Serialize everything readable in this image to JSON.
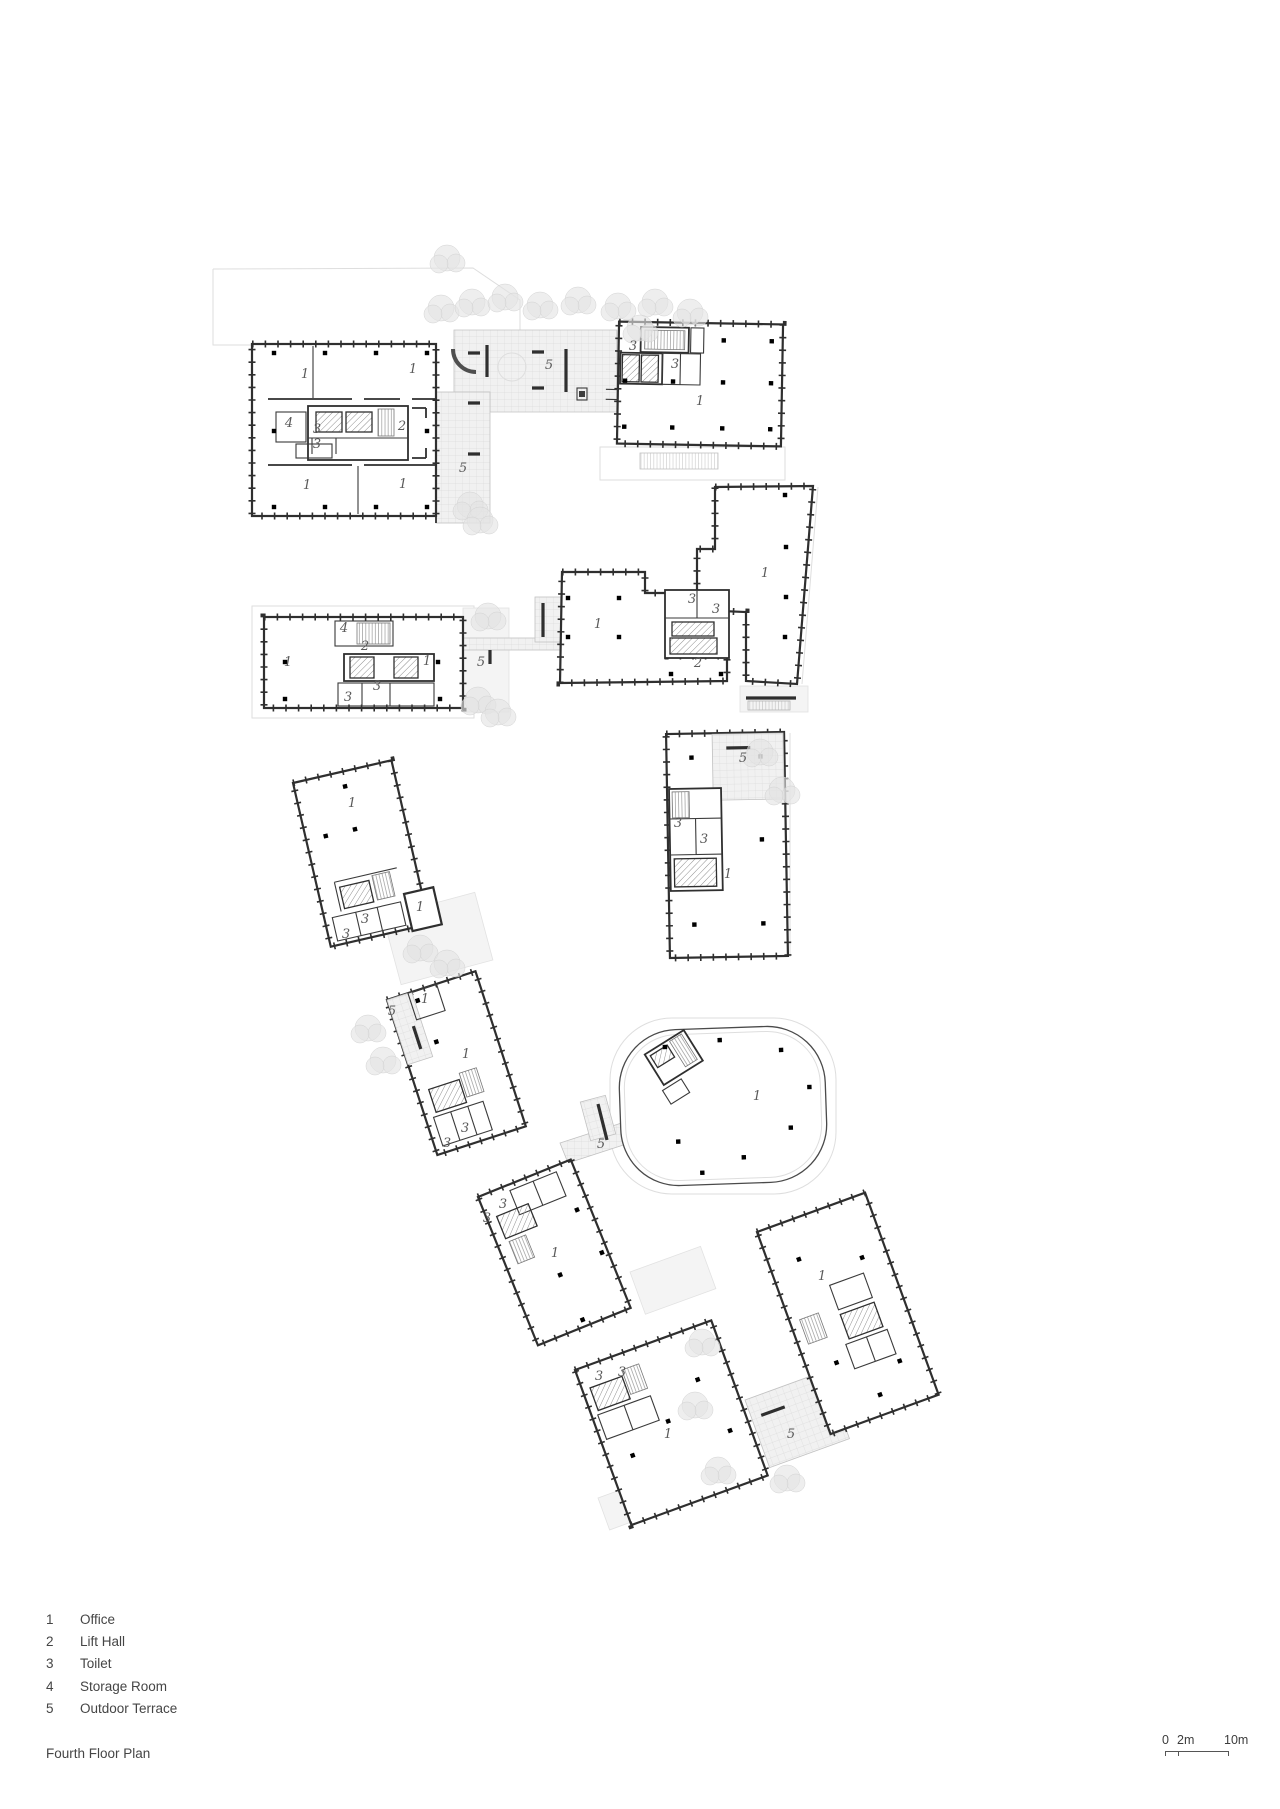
{
  "title": {
    "text": "Fourth Floor Plan"
  },
  "legend": {
    "items": [
      {
        "num": "1",
        "label": "Office"
      },
      {
        "num": "2",
        "label": "Lift Hall"
      },
      {
        "num": "3",
        "label": "Toilet"
      },
      {
        "num": "4",
        "label": "Storage Room"
      },
      {
        "num": "5",
        "label": "Outdoor Terrace"
      }
    ]
  },
  "scale_bar": {
    "zero": "0",
    "mid": "2m",
    "end": "10m"
  },
  "plan": {
    "colors": {
      "wall": "#2f2f2f",
      "room_label": "#5a5a5a",
      "terrace_fill": "#f1f1f1",
      "tree": "#e4e4e4",
      "ghost": "#dedede",
      "column": "#3d3d3d"
    },
    "room_labels": [
      {
        "t": "1",
        "x": 305,
        "y": 378
      },
      {
        "t": "1",
        "x": 413,
        "y": 373
      },
      {
        "t": "1",
        "x": 307,
        "y": 489
      },
      {
        "t": "1",
        "x": 403,
        "y": 488
      },
      {
        "t": "4",
        "x": 289,
        "y": 427
      },
      {
        "t": "3",
        "x": 317,
        "y": 433
      },
      {
        "t": "3",
        "x": 317,
        "y": 448
      },
      {
        "t": "2",
        "x": 402,
        "y": 430
      },
      {
        "t": "5",
        "x": 463,
        "y": 472
      },
      {
        "t": "5",
        "x": 549,
        "y": 369
      },
      {
        "t": "3",
        "x": 633,
        "y": 350
      },
      {
        "t": "3",
        "x": 675,
        "y": 368
      },
      {
        "t": "1",
        "x": 700,
        "y": 405
      },
      {
        "t": "1",
        "x": 765,
        "y": 577
      },
      {
        "t": "1",
        "x": 598,
        "y": 628
      },
      {
        "t": "2",
        "x": 698,
        "y": 667
      },
      {
        "t": "3",
        "x": 692,
        "y": 603
      },
      {
        "t": "3",
        "x": 716,
        "y": 613
      },
      {
        "t": "1",
        "x": 288,
        "y": 666
      },
      {
        "t": "1",
        "x": 427,
        "y": 665
      },
      {
        "t": "4",
        "x": 344,
        "y": 632
      },
      {
        "t": "2",
        "x": 365,
        "y": 650
      },
      {
        "t": "3",
        "x": 348,
        "y": 701
      },
      {
        "t": "3",
        "x": 377,
        "y": 690
      },
      {
        "t": "5",
        "x": 481,
        "y": 666
      },
      {
        "t": "5",
        "x": 743,
        "y": 762
      },
      {
        "t": "3",
        "x": 678,
        "y": 827
      },
      {
        "t": "3",
        "x": 704,
        "y": 843
      },
      {
        "t": "1",
        "x": 728,
        "y": 878
      },
      {
        "t": "1",
        "x": 352,
        "y": 807
      },
      {
        "t": "3",
        "x": 346,
        "y": 938
      },
      {
        "t": "3",
        "x": 365,
        "y": 923
      },
      {
        "t": "1",
        "x": 420,
        "y": 911
      },
      {
        "t": "5",
        "x": 392,
        "y": 1015
      },
      {
        "t": "1",
        "x": 425,
        "y": 1003
      },
      {
        "t": "1",
        "x": 466,
        "y": 1058
      },
      {
        "t": "3",
        "x": 447,
        "y": 1147
      },
      {
        "t": "3",
        "x": 465,
        "y": 1132
      },
      {
        "t": "5",
        "x": 601,
        "y": 1148
      },
      {
        "t": "1",
        "x": 757,
        "y": 1100
      },
      {
        "t": "1",
        "x": 555,
        "y": 1257
      },
      {
        "t": "3",
        "x": 503,
        "y": 1208
      },
      {
        "t": "3",
        "x": 487,
        "y": 1222
      },
      {
        "t": "1",
        "x": 822,
        "y": 1280
      },
      {
        "t": "5",
        "x": 791,
        "y": 1438
      },
      {
        "t": "1",
        "x": 668,
        "y": 1438
      },
      {
        "t": "3",
        "x": 599,
        "y": 1380
      },
      {
        "t": "3",
        "x": 622,
        "y": 1376
      }
    ]
  }
}
